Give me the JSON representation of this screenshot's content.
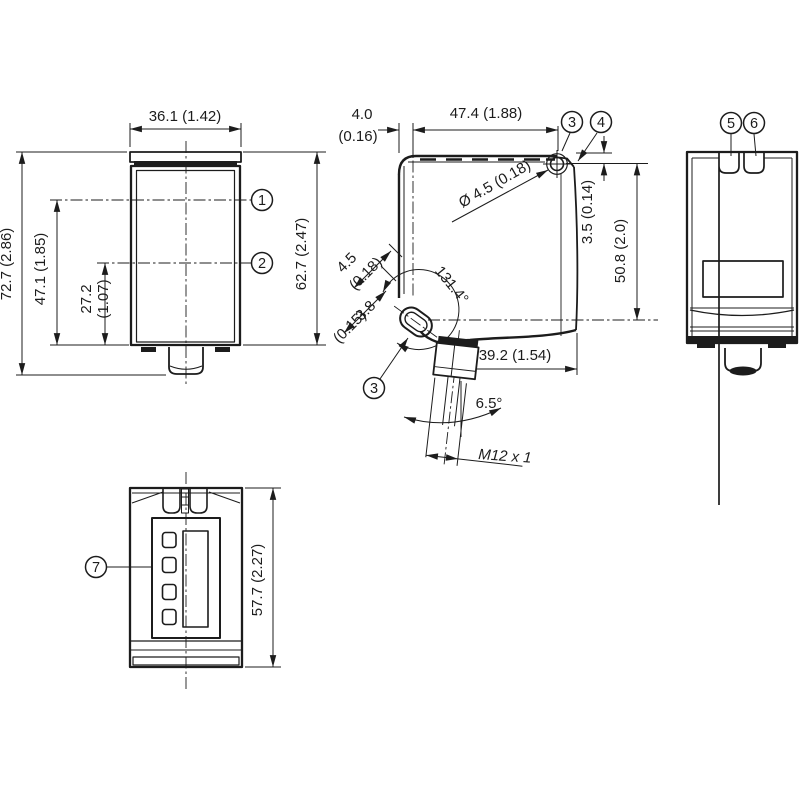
{
  "views": {
    "front": {
      "callout_1": "1",
      "callout_2": "2",
      "dim_width": "36.1 (1.42)",
      "dim_total_height": "72.7 (2.86)",
      "dim_axis1": "47.1 (1.85)",
      "dim_axis2_mm": "27.2",
      "dim_axis2_in": "(1.07)",
      "dim_housing_height": "62.7 (2.47)"
    },
    "side": {
      "dim_edge_mm": "4.0",
      "dim_edge_in": "(0.16)",
      "dim_hole_span": "47.4 (1.88)",
      "callout_3": "3",
      "callout_4": "4",
      "dim_hole_dia": "Ø 4.5 (0.18)",
      "dim_hole_top": "3.5 (0.14)",
      "dim_hole_vspan": "50.8 (2.0)",
      "dim_slot_len_mm": "4.5",
      "dim_slot_len_in": "(0.18)",
      "dim_slot_w_mm": "3.8",
      "dim_slot_w_in": "(0.15)",
      "angle_slot": "131.4°",
      "dim_depth": "39.2 (1.54)",
      "angle_connector": "6.5°",
      "thread": "M12 x 1"
    },
    "back": {
      "callout_5": "5",
      "callout_6": "6"
    },
    "bottom": {
      "callout_7": "7",
      "dim_height": "57.7 (2.27)"
    }
  }
}
